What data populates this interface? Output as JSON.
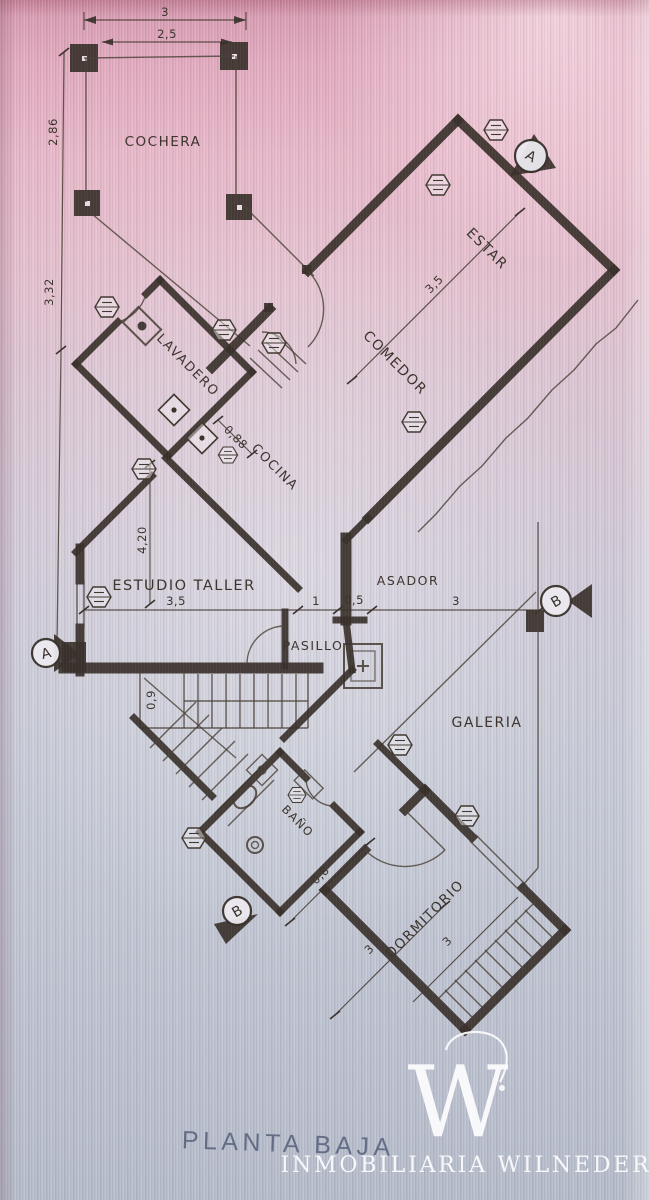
{
  "photo": {
    "bg_top": "#e2a8bd",
    "bg_mid": "#d2c8d6",
    "bg_bottom": "#b4bbc9",
    "ink": "#38302a",
    "title_color": "#4f5b76",
    "brand_color": "#fafbfd"
  },
  "rooms": {
    "cochera": "COCHERA",
    "estar": "ESTAR",
    "comedor": "COMEDOR",
    "lavadero": "LAVADERO",
    "cocina": "COCINA",
    "estudio_taller": "ESTUDIO TALLER",
    "pasillo": "PASILLO",
    "asador": "ASADOR",
    "galeria": "GALERIA",
    "bano": "BAÑO",
    "dormitorio": "DORMITORIO"
  },
  "dims": {
    "cochera_w": "3",
    "cochera_w2": "2,5",
    "cochera_h": "2,86",
    "side_h": "3,32",
    "band": "3,5",
    "cocina": "0,88",
    "estudio_w": "3,5",
    "estudio_h": "4,20",
    "pasillo": "1",
    "asador": "0,5",
    "galeria": "3",
    "stairs": "0,9",
    "bano": "0,8",
    "dorm_a": "3",
    "dorm_b": "3"
  },
  "markers": {
    "a": "A",
    "b": "B"
  },
  "title": "PLANTA BAJA",
  "brand": {
    "logo_letter": "W",
    "name": "INMOBILIARIA WILNEDER"
  }
}
